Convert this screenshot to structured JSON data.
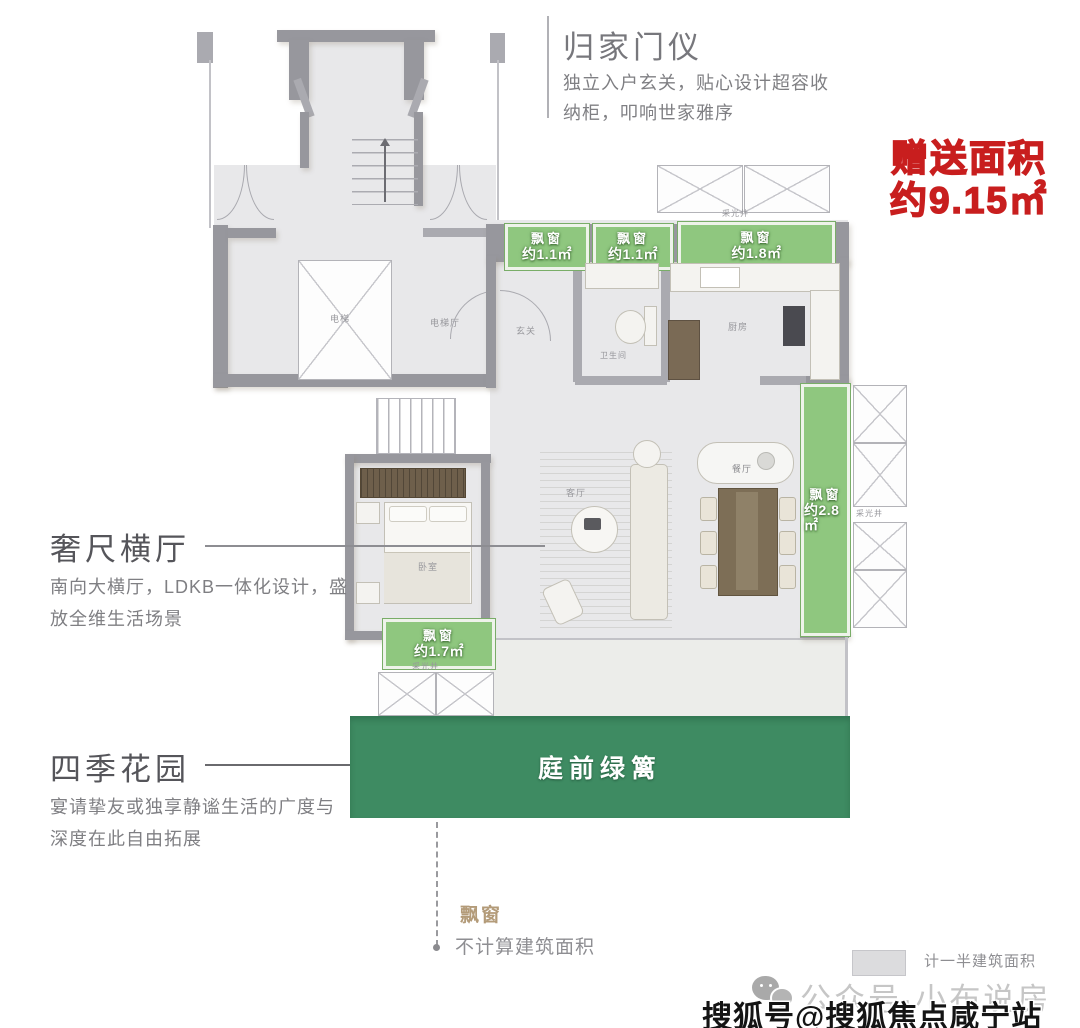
{
  "annotations": {
    "entry": {
      "title": "归家门仪",
      "desc1": "独立入户玄关，贴心设计超容收",
      "desc2": "纳柜，叩响世家雅序"
    },
    "hall": {
      "title": "奢尺横厅",
      "desc1": "南向大横厅，LDKB一体化设计，盛",
      "desc2": "放全维生活场景"
    },
    "garden": {
      "title": "四季花园",
      "desc1": "宴请挚友或独享静谧生活的广度与",
      "desc2": "深度在此自由拓展"
    },
    "bonus": {
      "line1": "赠送面积",
      "line2": "约9.15㎡",
      "color": "#c81e1e"
    }
  },
  "plan": {
    "rooms": {
      "elevator": "电梯",
      "elevator_hall": "电梯厅",
      "foyer": "玄关",
      "bathroom": "卫生间",
      "kitchen": "厨房",
      "living": "客厅",
      "dining": "餐厅",
      "bedroom": "卧室"
    },
    "light_well": "采光井",
    "bay_windows": [
      {
        "name": "飘窗",
        "area": "约1.1㎡"
      },
      {
        "name": "飘窗",
        "area": "约1.1㎡"
      },
      {
        "name": "飘窗",
        "area": "约1.8㎡"
      },
      {
        "name": "飘窗",
        "area": "约2.8㎡"
      },
      {
        "name": "飘窗",
        "area": "约1.7㎡"
      }
    ],
    "hedge": "庭前绿篱",
    "colors": {
      "bay_green": "#8fc77f",
      "hedge_green": "#3e8b62",
      "wall_gray": "#97979d"
    }
  },
  "legend": {
    "bay_title": "飘窗",
    "bay_desc": "不计算建筑面积",
    "half_label": "计一半建筑面积"
  },
  "watermark": {
    "wechat": "公众号·小布说房",
    "sohu": "搜狐号@搜狐焦点咸宁站"
  }
}
